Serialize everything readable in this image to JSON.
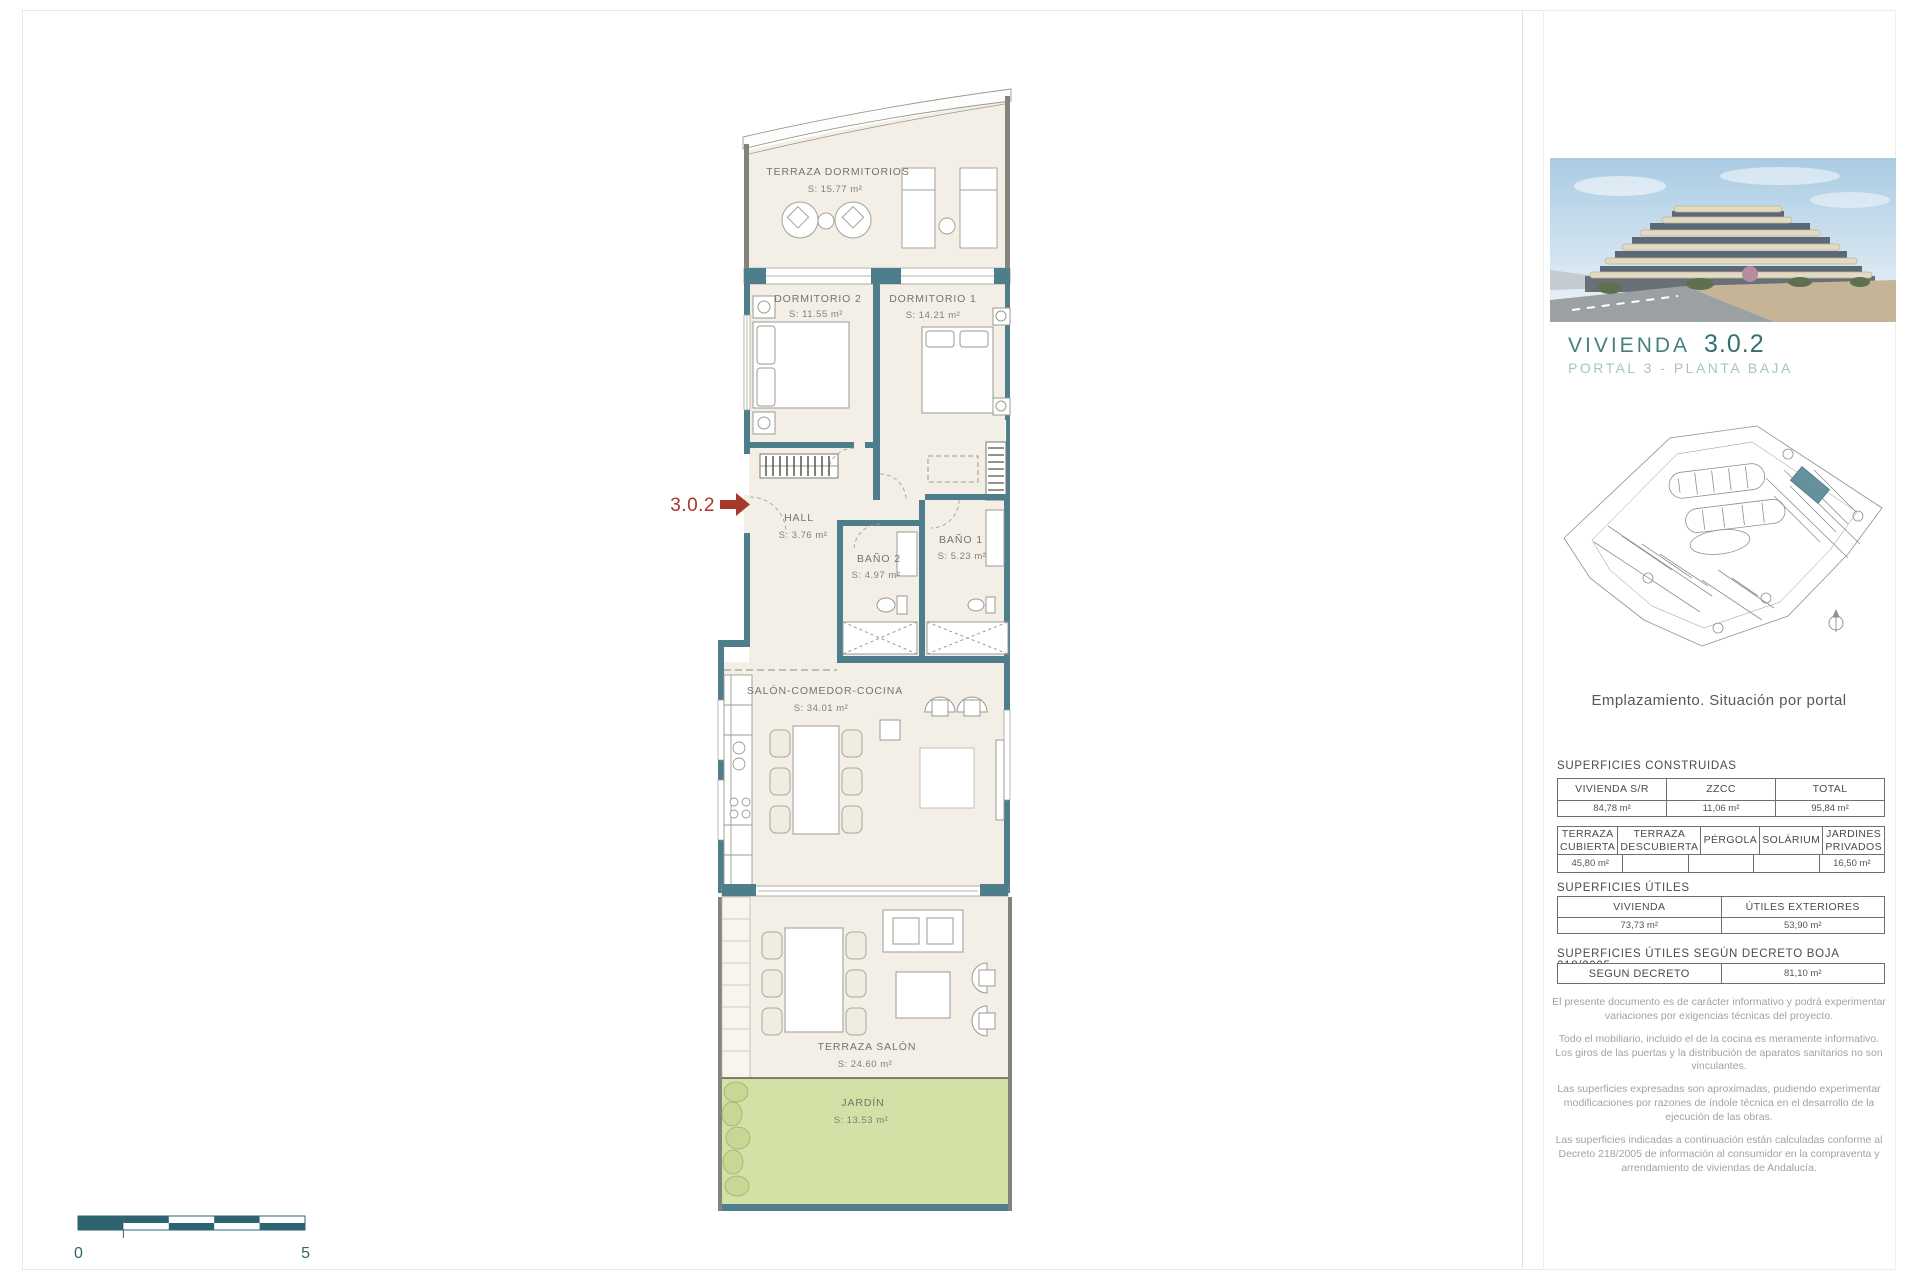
{
  "document": {
    "unit_marker": "3.0.2",
    "scale_bar": {
      "start": "0",
      "end": "5"
    }
  },
  "floor_plan": {
    "rooms": [
      {
        "name": "TERRAZA DORMITORIOS",
        "area": "S: 15.77 m²"
      },
      {
        "name": "DORMITORIO 2",
        "area": "S: 11.55 m²"
      },
      {
        "name": "DORMITORIO 1",
        "area": "S: 14.21 m²"
      },
      {
        "name": "HALL",
        "area": "S: 3.76 m²"
      },
      {
        "name": "BAÑO 2",
        "area": "S: 4.97 m²"
      },
      {
        "name": "BAÑO 1",
        "area": "S: 5.23 m²"
      },
      {
        "name": "SALÓN-COMEDOR-COCINA",
        "area": "S: 34.01 m²"
      },
      {
        "name": "TERRAZA SALÓN",
        "area": "S: 24.60 m²"
      },
      {
        "name": "JARDÍN",
        "area": "S: 13.53 m²"
      }
    ]
  },
  "sidebar": {
    "title": "VIVIENDA",
    "unit": "3.0.2",
    "subtitle": "PORTAL 3 - PLANTA BAJA",
    "site_caption": "Emplazamiento. Situación por portal",
    "superficies_construidas": {
      "heading": "SUPERFICIES CONSTRUIDAS",
      "table1": {
        "headers": [
          "VIVIENDA S/R",
          "ZZCC",
          "TOTAL"
        ],
        "values": [
          "84,78 m²",
          "11,06 m²",
          "95,84 m²"
        ]
      },
      "table2": {
        "headers": [
          "TERRAZA CUBIERTA",
          "TERRAZA DESCUBIERTA",
          "PÉRGOLA",
          "SOLÁRIUM",
          "JARDINES PRIVADOS"
        ],
        "values": [
          "45,80 m²",
          "",
          "",
          "",
          "16,50 m²"
        ]
      }
    },
    "superficies_utiles": {
      "heading": "SUPERFICIES ÚTILES",
      "headers": [
        "VIVIENDA",
        "ÚTILES EXTERIORES"
      ],
      "values": [
        "73,73 m²",
        "53,90 m²"
      ]
    },
    "superficies_decreto": {
      "heading": "SUPERFICIES ÚTILES SEGÚN DECRETO BOJA 218/2005",
      "label": "SEGUN DECRETO",
      "value": "81,10 m²"
    },
    "disclaimers": [
      "El presente documento es de carácter informativo y podrá experimentar variaciones por exigencias técnicas del proyecto.",
      "Todo el mobiliario, incluido el de la cocina es meramente informativo. Los giros de las puertas y la distribución de aparatos sanitarios no son vinculantes.",
      "Las superficies expresadas son aproximadas, pudiendo experimentar modificaciones por razones de índole técnica en el desarrollo de la ejecución de las obras.",
      "Las superficies indicadas a continuación están calculadas conforme al Decreto 218/2005 de información al consumidor en la compraventa y arrendamiento de viviendas de Andalucía."
    ]
  },
  "colors": {
    "wall_teal": "#4e7d8b",
    "marker_red": "#a5392b",
    "title_teal": "#44807f",
    "subtitle_green": "#a6c6b3",
    "garden_green": "#d3e0a6",
    "scale_teal": "#2d6470"
  }
}
